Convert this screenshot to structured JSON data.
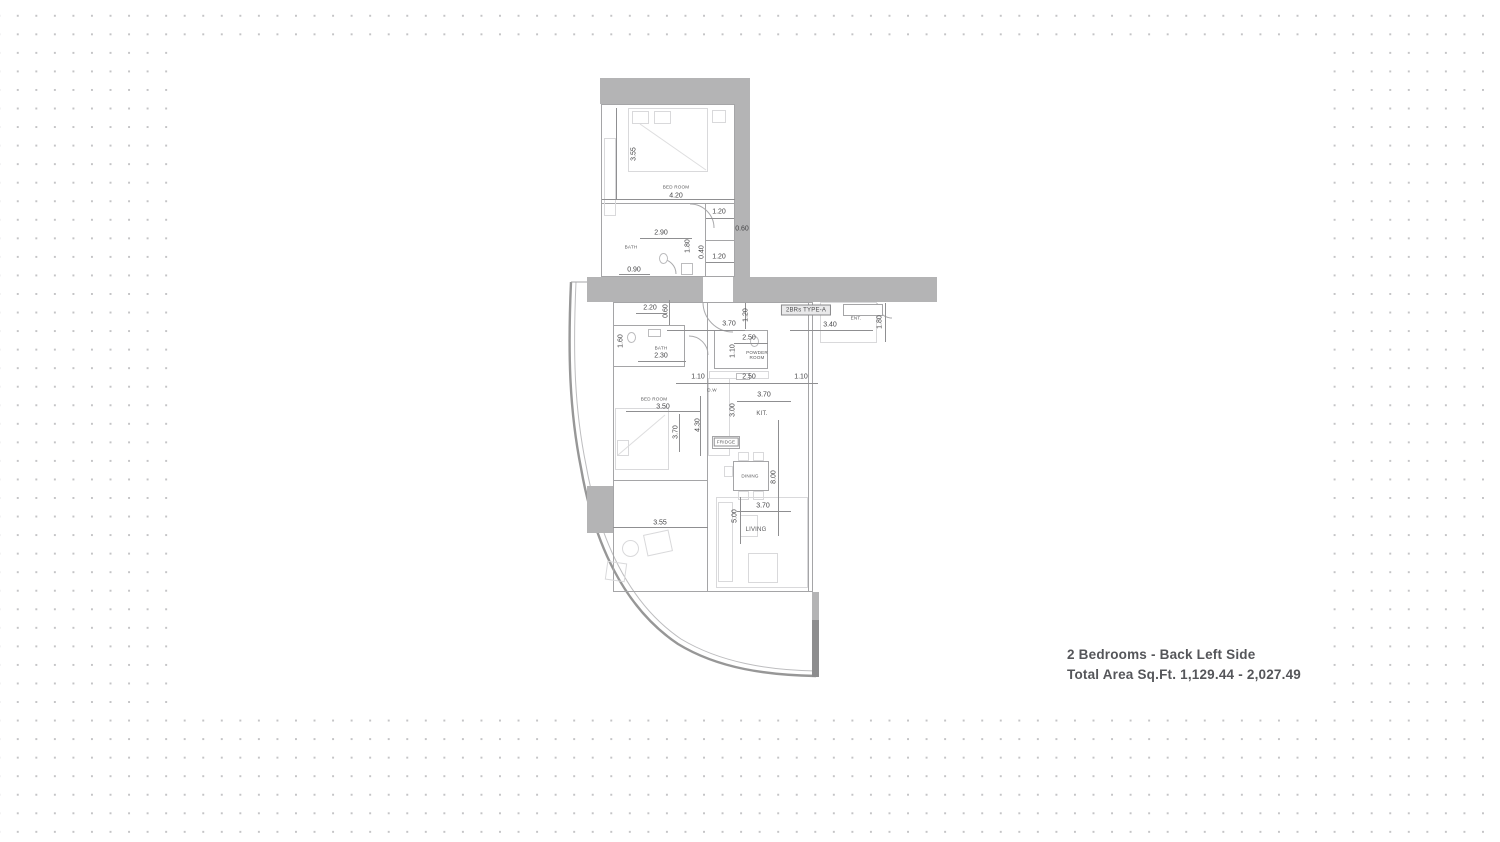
{
  "caption": {
    "title": "2 Bedrooms - Back Left Side",
    "subtitle": "Total Area Sq.Ft. 1,129.44 - 2,027.49"
  },
  "plan": {
    "unit_type_label": "2BRs TYPE-A",
    "colors": {
      "wall": "#b4b4b5",
      "wall_dark": "#8d8d8e",
      "outline": "#a5a5a7",
      "furniture": "#d9d9db",
      "dimension_text": "#454547",
      "caption_text": "#55565a",
      "background_dot": "#c4c4c6"
    },
    "rooms": [
      {
        "text": "BED ROOM",
        "x": 676,
        "y": 187,
        "cls": "tiny"
      },
      {
        "text": "BATH",
        "x": 631,
        "y": 247,
        "cls": "tiny"
      },
      {
        "text": "BATH",
        "x": 661,
        "y": 348,
        "cls": "tiny"
      },
      {
        "text": "POWDER\nROOM",
        "x": 757,
        "y": 355,
        "cls": "tiny"
      },
      {
        "text": "BED ROOM",
        "x": 654,
        "y": 399,
        "cls": "tiny"
      },
      {
        "text": "KIT.",
        "x": 762,
        "y": 414,
        "cls": ""
      },
      {
        "text": "DINING",
        "x": 750,
        "y": 476,
        "cls": "tiny"
      },
      {
        "text": "LIVING",
        "x": 756,
        "y": 530,
        "cls": ""
      },
      {
        "text": "ENT.",
        "x": 856,
        "y": 318,
        "cls": "tiny"
      },
      {
        "text": "D.W",
        "x": 712,
        "y": 390,
        "cls": "tiny"
      },
      {
        "text": "FRIDGE",
        "x": 726,
        "y": 442,
        "cls": "boxed"
      },
      {
        "text": "2BRs TYPE-A",
        "x": 806,
        "y": 310,
        "cls": "unit"
      }
    ],
    "dimensions": [
      {
        "text": "3.55",
        "x": 634,
        "y": 154,
        "v": true
      },
      {
        "text": "4.20",
        "x": 676,
        "y": 196
      },
      {
        "text": "1.20",
        "x": 719,
        "y": 212
      },
      {
        "text": "2.90",
        "x": 661,
        "y": 233
      },
      {
        "text": "0.60",
        "x": 742,
        "y": 229
      },
      {
        "text": "1.80",
        "x": 688,
        "y": 246,
        "v": true
      },
      {
        "text": "0.40",
        "x": 702,
        "y": 252,
        "v": true
      },
      {
        "text": "1.20",
        "x": 719,
        "y": 257
      },
      {
        "text": "0.90",
        "x": 634,
        "y": 270
      },
      {
        "text": "2.20",
        "x": 650,
        "y": 308
      },
      {
        "text": "0.60",
        "x": 666,
        "y": 311,
        "v": true
      },
      {
        "text": "3.70",
        "x": 729,
        "y": 324
      },
      {
        "text": "1.20",
        "x": 746,
        "y": 315,
        "v": true
      },
      {
        "text": "3.40",
        "x": 830,
        "y": 325
      },
      {
        "text": "1.80",
        "x": 880,
        "y": 322,
        "v": true
      },
      {
        "text": "1.60",
        "x": 621,
        "y": 341,
        "v": true
      },
      {
        "text": "2.30",
        "x": 661,
        "y": 356
      },
      {
        "text": "2.50",
        "x": 749,
        "y": 338
      },
      {
        "text": "1.10",
        "x": 733,
        "y": 351,
        "v": true
      },
      {
        "text": "1.10",
        "x": 698,
        "y": 377
      },
      {
        "text": "2.50",
        "x": 749,
        "y": 377
      },
      {
        "text": "1.10",
        "x": 801,
        "y": 377
      },
      {
        "text": "3.50",
        "x": 663,
        "y": 407
      },
      {
        "text": "3.70",
        "x": 764,
        "y": 395
      },
      {
        "text": "3.00",
        "x": 733,
        "y": 410,
        "v": true
      },
      {
        "text": "3.70",
        "x": 676,
        "y": 432,
        "v": true
      },
      {
        "text": "4.30",
        "x": 698,
        "y": 425,
        "v": true
      },
      {
        "text": "8.00",
        "x": 774,
        "y": 477,
        "v": true
      },
      {
        "text": "3.70",
        "x": 763,
        "y": 506
      },
      {
        "text": "5.00",
        "x": 735,
        "y": 516,
        "v": true
      },
      {
        "text": "3.55",
        "x": 660,
        "y": 523
      }
    ]
  }
}
